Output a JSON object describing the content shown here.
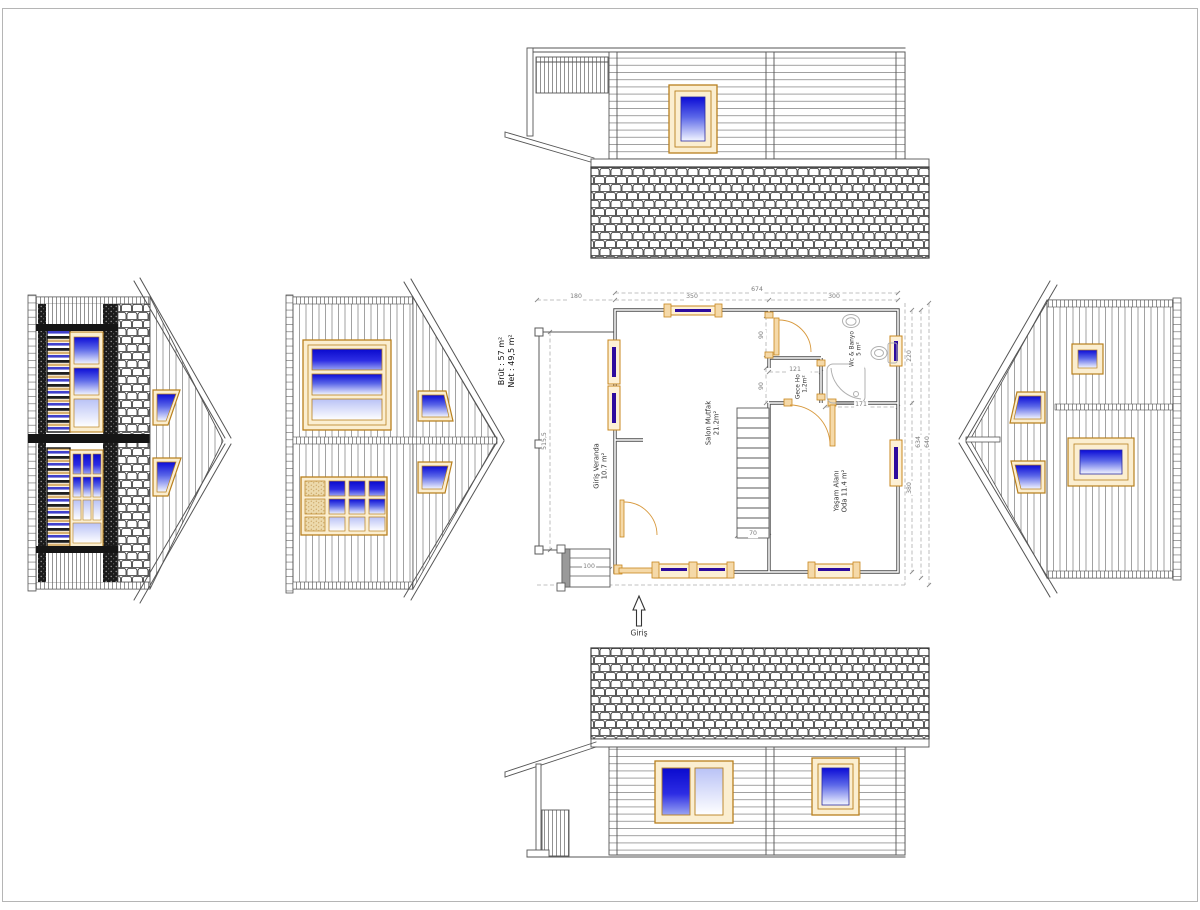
{
  "drawing": {
    "type": "house floor plan with four elevations",
    "area_summary": {
      "net": "Net : 49,5 m²",
      "brut": "Brüt : 57  m²"
    },
    "entrance_label": "Giriş",
    "rooms": {
      "veranda": {
        "name": "Giriş Veranda",
        "area": "10.7 m²"
      },
      "salon": {
        "name": "Salon Mutfak",
        "area": "21.2m²"
      },
      "hall": {
        "name": "Gece Holü",
        "area": "1,2m²"
      },
      "bath": {
        "name": "Wc & Banyo",
        "area": "5 m²"
      },
      "living": {
        "name": "Yaşam Alanı",
        "area": "Oda 11.4 m²"
      }
    },
    "dimensions": {
      "total_width": "674",
      "veranda_width": "180",
      "salon_width": "350",
      "right_width": "300",
      "veranda_depth": "515,5",
      "steps_width": "100",
      "stairs_width": "70",
      "hall_width": "121",
      "bath_width": "171",
      "door_opening_top": "90",
      "door_opening_bottom": "90",
      "bath_depth": "220",
      "living_depth": "380",
      "depth_inner": "634",
      "depth_outer": "640"
    },
    "colors": {
      "frame_orange": "#c8871f",
      "frame_fill": "#fbeed0",
      "glass_blue": "#1212cc",
      "wall_gray": "#4a4a4a",
      "dim_gray": "#8c8c8c"
    }
  }
}
